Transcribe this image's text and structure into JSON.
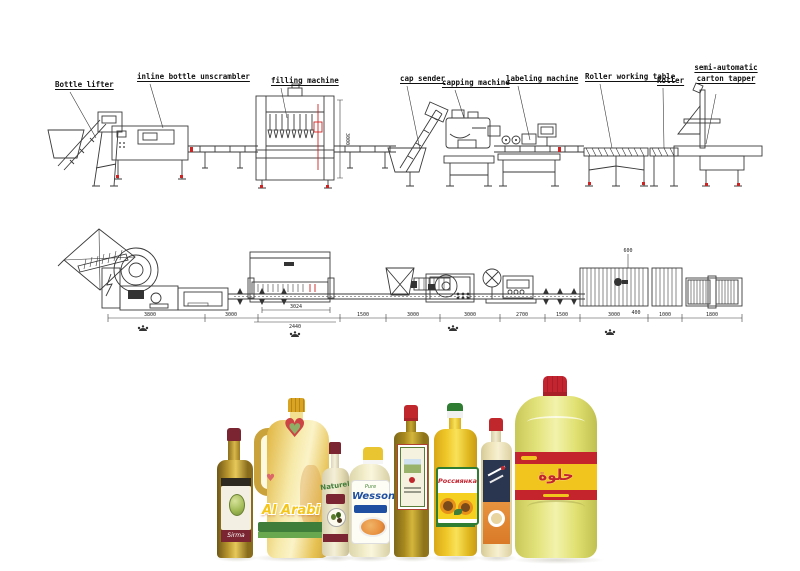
{
  "top_view": {
    "machine_labels": [
      "Bottle lifter",
      "inline bottle unscrambler",
      "filling machine",
      "cap sender",
      "capping machine",
      "labeling machine",
      "Roller working table",
      "Roller",
      "semi-automatic carton tapper"
    ],
    "vertical_dimension": "3000"
  },
  "side_view": {
    "dimensions": [
      "3800",
      "3000",
      "3024",
      "2440",
      "1500",
      "3000",
      "3000",
      "2700",
      "1500",
      "3000",
      "1000",
      "1800"
    ],
    "height_marks": [
      "600",
      "400"
    ]
  },
  "bottles": [
    {
      "brand": "Sirma",
      "cap_color": "#7a2531"
    },
    {
      "brand": "Al Arabi",
      "cap_color": "#d9a520"
    },
    {
      "brand": "Naturel",
      "cap_color": "#7a2531"
    },
    {
      "brand": "Wesson",
      "sub_brand": "Pure",
      "cap_color": "#e8c531"
    },
    {
      "brand": "",
      "cap_color": "#c0272d"
    },
    {
      "brand": "Россиянка",
      "cap_color": "#2e7d32"
    },
    {
      "brand": "",
      "cap_color": "#c0272d"
    },
    {
      "brand": "حلوة",
      "cap_color": "#c42430"
    }
  ],
  "colors": {
    "line": "#3a3a3a",
    "accent_red": "#cc2222",
    "background": "#ffffff"
  }
}
